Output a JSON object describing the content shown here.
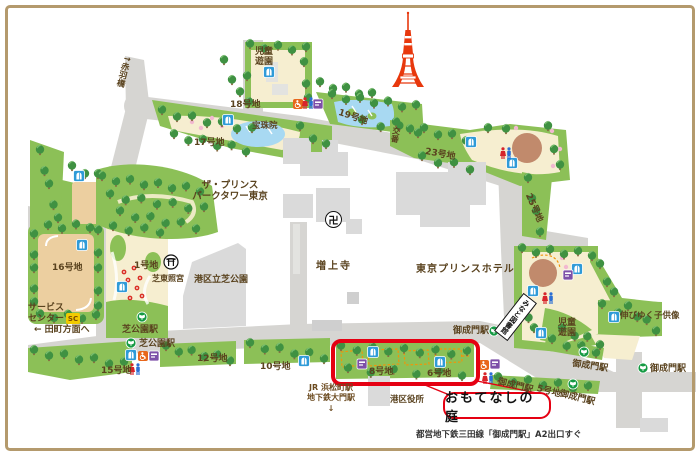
{
  "colors": {
    "park_green": "#8cc057",
    "path_cream": "#f6eed0",
    "road_gray": "#d6d5d2",
    "building_gray": "#dadada",
    "water_blue": "#a8d9f2",
    "field_tan": "#eccfa0",
    "plaza_brown": "#c18a6c",
    "highlight_red": "#e50012",
    "label_brown": "#5a431f",
    "tower_red": "#e8380d",
    "subway_green": "#159a43",
    "toilet_blue": "#2f9bd8",
    "wheelchair_orange": "#e8671b",
    "facility_purple": "#7d4fa8",
    "sc_yellow": "#f2cb00",
    "frame_tan": "#b49a6d"
  },
  "plots": {
    "no1": "1号地",
    "no5": "5号地",
    "no6": "6号地",
    "no8": "8号地",
    "no10": "10号地",
    "no12": "12号地",
    "no15": "15号地",
    "no16": "16号地",
    "no17": "17号地",
    "no18": "18号地",
    "no19": "19号地",
    "no23": "23号地",
    "no25": "25号地"
  },
  "stations": {
    "shibakoen": "芝公園駅",
    "onarimon": "御成門駅",
    "jr_hamamatsucho": "JR 浜松町駅",
    "daimon": "地下鉄大門駅",
    "down_arrow": "↓"
  },
  "places": {
    "children_park": "児童\n遊園",
    "hoshuin": "宝珠院",
    "akabanebashi": "↑赤羽橋",
    "prince_park_tower": "ザ・プリンス\nパークタワー東京",
    "koban": "交番",
    "zojoji": "増上寺",
    "manji": "卍",
    "shiba_park_minato": "港区立芝公園",
    "tokyo_prince_hotel": "東京プリンスホテル",
    "shiba_toshogu": "芝東照宮",
    "service_center": "サービス\nセンター",
    "sc_badge": "SC",
    "tamachi": "← 田町方面へ",
    "minato_library": "みなと図書館",
    "nobiyuku_statue": "伸びゆく子供像",
    "city_office": "港区役所"
  },
  "highlight": {
    "title": "おもてなしの庭",
    "access_note": "都営地下鉄三田線「御成門駅」A2出口すぐ"
  },
  "icons": {
    "toei_subway": "toei-subway-entrance-icon",
    "restroom": "restroom-icon",
    "accessible_restroom": "accessible-restroom-icon",
    "male_female_restroom": "male-female-restroom-icon",
    "multipurpose_facility": "multipurpose-facility-icon",
    "torii": "torii-shrine-icon",
    "temple": "temple-manji-icon",
    "tokyo_tower": "tokyo-tower-icon",
    "police_box": "交番"
  }
}
